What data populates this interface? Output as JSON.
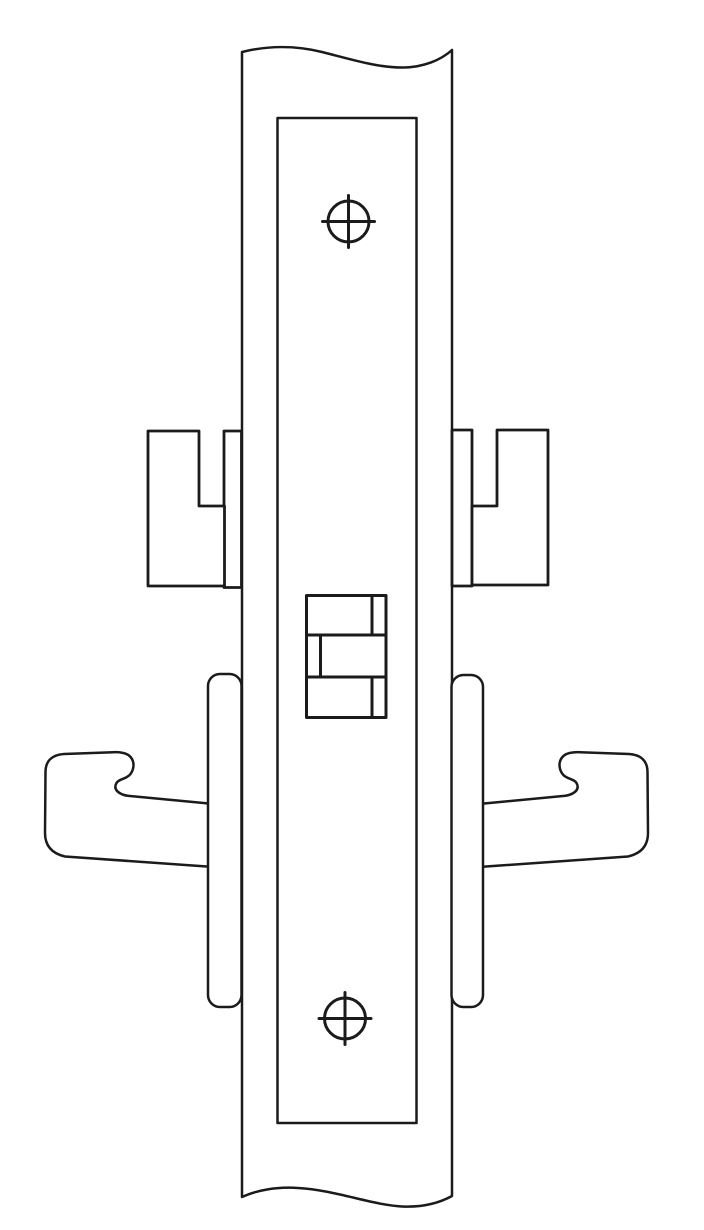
{
  "colors": {
    "line": "#1b1b1b",
    "background": "#ffffff"
  },
  "diagram": {
    "title": "Mortise lock with lever trim - technical line drawing (door edge view)",
    "style": "black-and-white outline illustration, no text or labels",
    "screw_count": 2,
    "components": [
      {
        "name": "door-edge-panel",
        "description": "vertical door edge strip with wavy break lines at top and bottom"
      },
      {
        "name": "faceplate",
        "description": "tall mortise case faceplate mounted on the door edge"
      },
      {
        "name": "top-screw",
        "description": "round faceplate mounting screw head with cross slot"
      },
      {
        "name": "bottom-screw",
        "description": "round faceplate mounting screw head with cross slot"
      },
      {
        "name": "latch-assembly",
        "description": "latchbolt with auxiliary deadlatch shown as three stacked segments"
      },
      {
        "name": "left-hub-block",
        "description": "notched hub/housing block protruding on the left side"
      },
      {
        "name": "left-hub-strip",
        "description": "thin trim strip between left hub block and door edge"
      },
      {
        "name": "right-hub-block",
        "description": "notched hub/housing block protruding on the right side (mirrored)"
      },
      {
        "name": "right-hub-strip",
        "description": "thin trim strip between right hub block and door edge"
      },
      {
        "name": "left-lever",
        "description": "hook-style door lever handle, left side profile"
      },
      {
        "name": "right-lever",
        "description": "hook-style door lever handle, right side profile (mirrored)"
      },
      {
        "name": "left-rose",
        "description": "rounded rose/escutcheon plate edge, left side"
      },
      {
        "name": "right-rose",
        "description": "rounded rose/escutcheon plate edge, right side"
      }
    ]
  }
}
